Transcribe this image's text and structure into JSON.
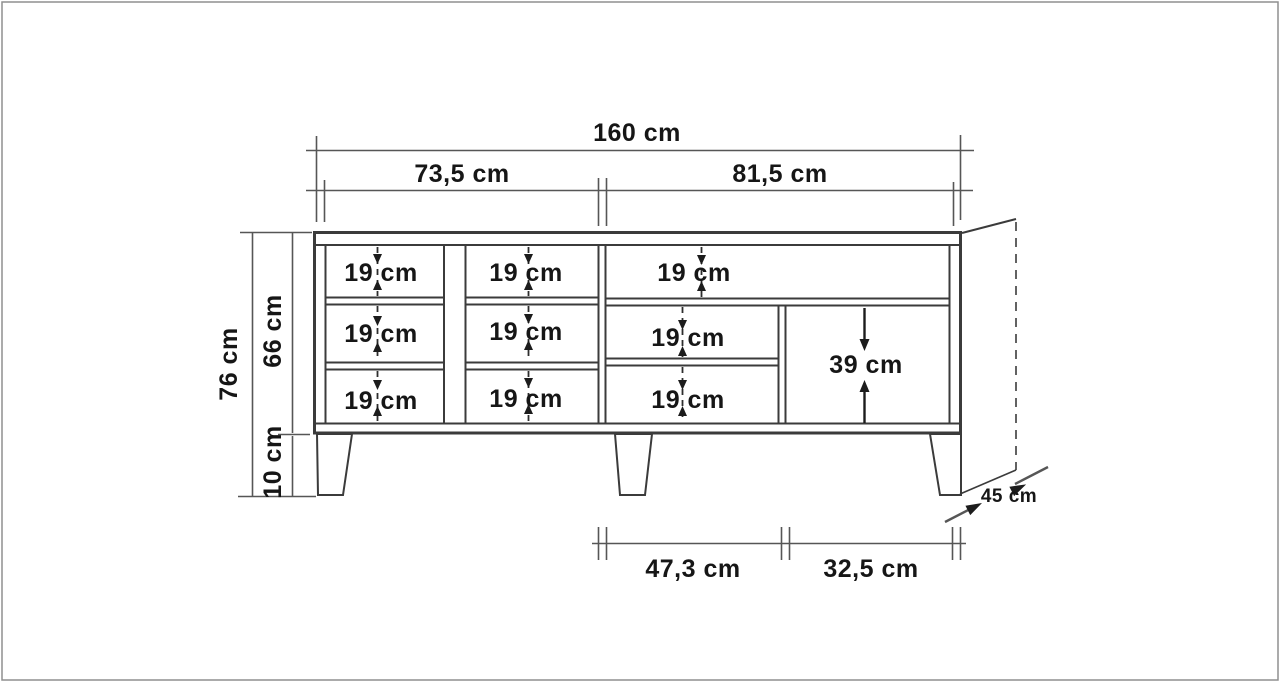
{
  "drawing": {
    "kind": "furniture-dimension-drawing",
    "views": [
      "front",
      "side-depth-hint"
    ],
    "unit": "cm",
    "line_color": "#3b3b3b",
    "dim_color": "#565656",
    "text_color": "#161616",
    "background": "#ffffff"
  },
  "dims": {
    "width_total": "160 cm",
    "width_left_section": "73,5 cm",
    "width_right_section": "81,5 cm",
    "height_total": "76 cm",
    "height_body": "66 cm",
    "height_legs": "10 cm",
    "depth": "45 cm",
    "bottom_span_left": "47,3 cm",
    "bottom_span_right": "32,5 cm",
    "right_compartment_height": "39 cm"
  },
  "compartments": [
    {
      "id": "col1-row1",
      "label": "19 cm"
    },
    {
      "id": "col2-row1",
      "label": "19 cm"
    },
    {
      "id": "right-row1",
      "label": "19 cm"
    },
    {
      "id": "col1-row2",
      "label": "19 cm"
    },
    {
      "id": "col2-row2",
      "label": "19 cm"
    },
    {
      "id": "right-row2",
      "label": "19 cm"
    },
    {
      "id": "col1-row3",
      "label": "19 cm"
    },
    {
      "id": "col2-row3",
      "label": "19 cm"
    },
    {
      "id": "right-row3",
      "label": "19 cm"
    }
  ]
}
